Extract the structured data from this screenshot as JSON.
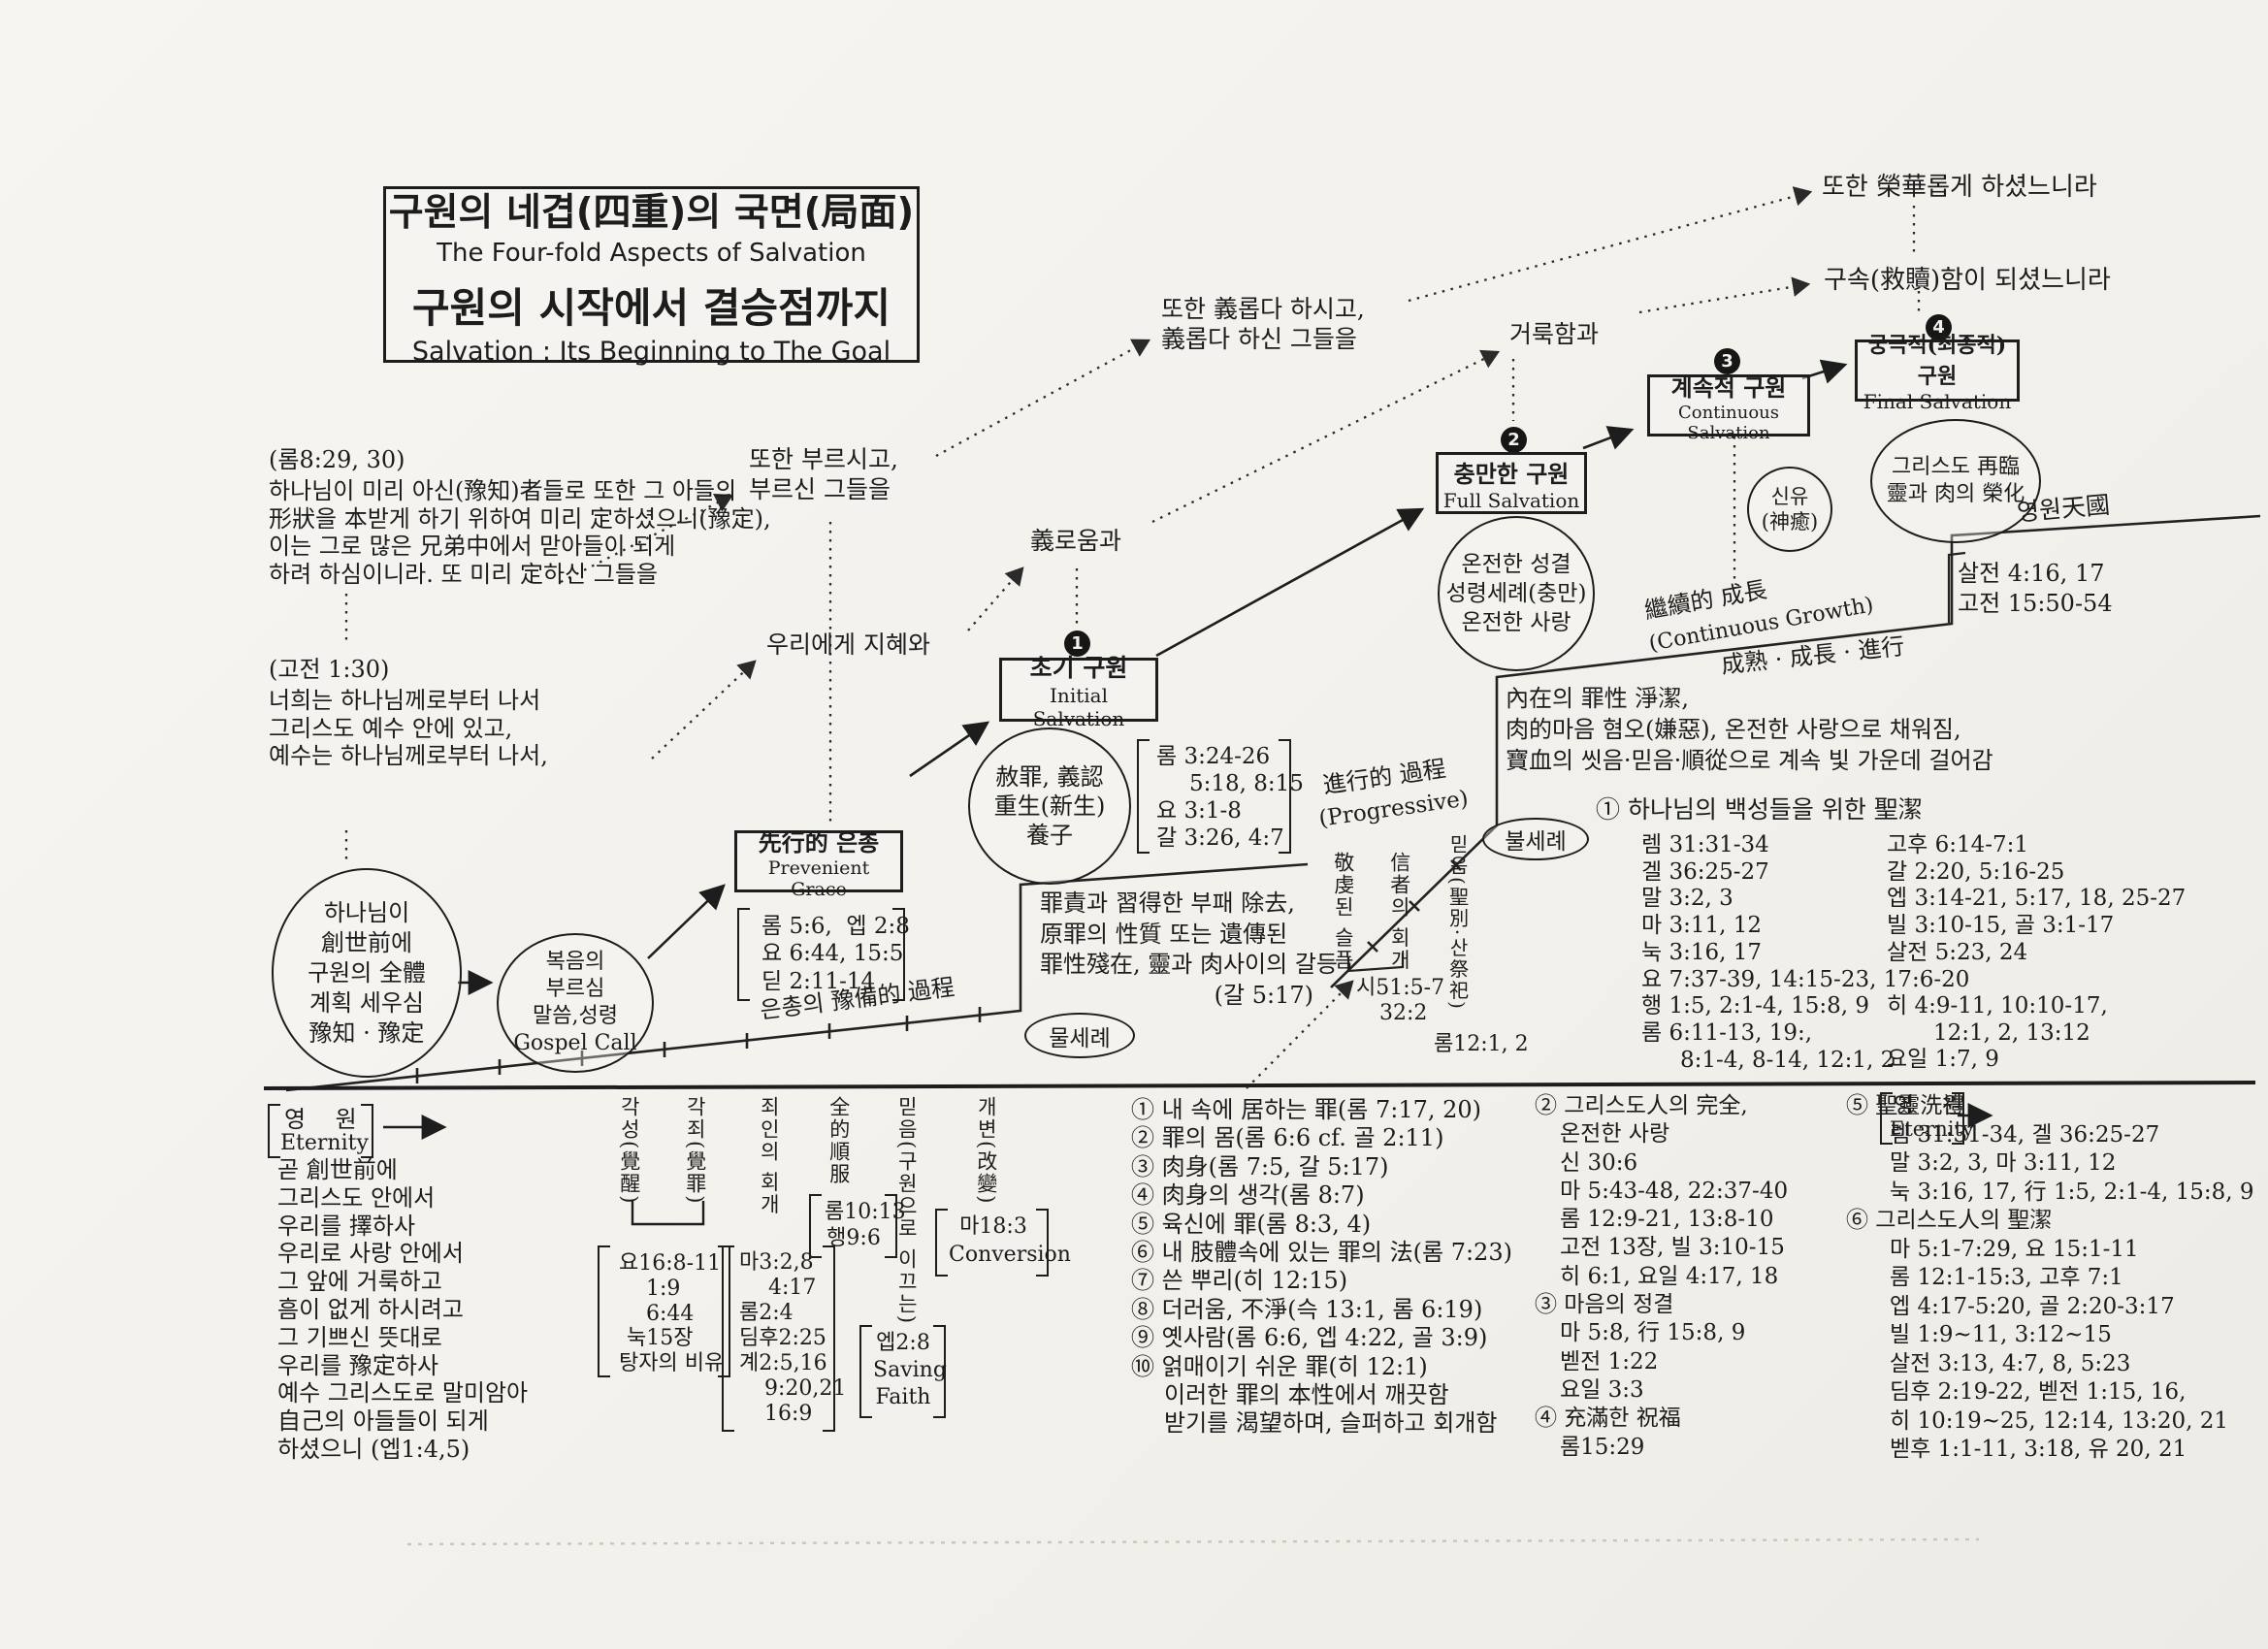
{
  "title": {
    "ko1": "구원의 네겹(四重)의 국면(局面)",
    "en1": "The Four-fold Aspects of Salvation",
    "ko2": "구원의 시작에서 결승점까지",
    "en2": "Salvation : Its Beginning to The Goal"
  },
  "quotes": {
    "rom8_ref": "(롬8:29, 30)",
    "rom8_lines": [
      "하나님이 미리 아신(豫知)者들로 또한 그 아들의",
      "形狀을 本받게 하기 위하여 미리 定하셨으니(豫定),",
      "이는 그로 많은 兄弟中에서 맏아들이 되게",
      "하려 하심이니라. 또 미리 定하신 그들을"
    ],
    "cor1_ref": "(고전 1:30)",
    "cor1_lines": [
      "너희는 하나님께로부터 나서",
      "그리스도 예수 안에 있고,",
      "예수는 하나님께로부터 나서,"
    ],
    "called_lines": [
      "또한 부르시고,",
      "부르신 그들을"
    ],
    "wisdom": "우리에게 지혜와",
    "righteousness": "義로움과",
    "justified_lines": [
      "또한 義롭다 하시고,",
      "義롭다 하신 그들을"
    ],
    "holiness": "거룩함과",
    "glorified": "또한 榮華롭게 하셨느니라",
    "redeemed": "구속(救贖)함이 되셨느니라"
  },
  "ovals": {
    "plan": [
      "하나님이",
      "創世前에",
      "구원의 全體",
      "계획 세우심",
      "豫知 · 豫定"
    ],
    "gospel_call": [
      "복음의",
      "부르심",
      "말씀,성령",
      "Gospel Call"
    ],
    "initial_grace": [
      "赦罪, 義認",
      "重生(新生)",
      "養子"
    ],
    "full_grace": [
      "온전한 성결",
      "성령세례(충만)",
      "온전한 사랑"
    ],
    "healing": [
      "신유",
      "(神癒)"
    ],
    "second_coming": [
      "그리스도 再臨",
      "靈과 肉의 榮化"
    ],
    "water_baptism": "물세례",
    "fire_baptism": "불세례"
  },
  "stages": [
    {
      "num": "1",
      "ko": "초기 구원",
      "en": "Initial Salvation"
    },
    {
      "num": "2",
      "ko": "충만한 구원",
      "en": "Full Salvation"
    },
    {
      "num": "3",
      "ko": "계속적 구원",
      "en": "Continuous Salvation"
    },
    {
      "num": "4",
      "ko": "궁극적(최종적) 구원",
      "en": "Final Salvation"
    }
  ],
  "prevenient": {
    "ko": "先行的 은총",
    "en": "Prevenient Grace",
    "verses": [
      "롬 5:6,  엡 2:8",
      "요 6:44, 15:5",
      "딛 2:11-14"
    ]
  },
  "initial_verses": [
    "롬 3:24-26",
    "5:18, 8:15",
    "요 3:1-8",
    "갈 3:26, 4:7"
  ],
  "process": {
    "preparatory": "은총의 豫備的 過程",
    "progressive_ko": "進行的 過程",
    "progressive_en": "(Progressive)",
    "growth_ko": "繼續的 成長",
    "growth_en": "(Continuous Growth)",
    "maturity": "成熟 · 成長 · 進行",
    "heaven": "영원天國"
  },
  "sin_box": [
    "罪責과 習得한 부패 除去,",
    "原罪의 性質 또는 遺傳된",
    "罪性殘在, 靈과 肉사이의 갈등",
    "(갈 5:17)"
  ],
  "inner_box": [
    "內在의 罪性 淨潔,",
    "肉的마음 혐오(嫌惡), 온전한 사랑으로 채워짐,",
    "寶血의 씻음·믿음·順從으로 계속 빛 가운데 걸어감"
  ],
  "vertical_mid": {
    "godly_sorrow": "敬虔된 슬픔",
    "believer_repentance": "信者의 회개",
    "sorrow_refs": [
      "시51:5-7",
      "32:2"
    ],
    "faith_consecration": "믿음(聖別·산祭祀)",
    "consecration_ref": "롬12:1, 2"
  },
  "final_refs": [
    "살전 4:16, 17",
    "고전 15:50-54"
  ],
  "sanctify_list": {
    "heading": "① 하나님의 백성들을 위한 聖潔",
    "left": [
      "렘 31:31-34",
      "겔 36:25-27",
      "말 3:2, 3",
      "마 3:11, 12",
      "눅 3:16, 17",
      "요 7:37-39, 14:15-23, 17:6-20",
      "행 1:5, 2:1-4, 15:8, 9",
      "롬 6:11-13, 19:,",
      "8:1-4, 8-14, 12:1, 2"
    ],
    "right_top": [
      "고후 6:14-7:1",
      "갈 2:20, 5:16-25",
      "엡 3:14-21, 5:17, 18, 25-27",
      "빌 3:10-15, 골 3:1-17",
      "살전 5:23, 24"
    ],
    "right_bottom": [
      "히 4:9-11, 10:10-17,",
      "12:1, 2, 13:12",
      "요일 1:7, 9"
    ]
  },
  "eternity": {
    "ko": "영    원",
    "en": "Eternity"
  },
  "bottom_left_lines": [
    "곧 創世前에",
    "그리스도 안에서",
    "우리를 擇하사",
    "우리로 사랑 안에서",
    "그 앞에 거룩하고",
    "흠이 없게 하시려고",
    "그 기쁘신 뜻대로",
    "우리를 豫定하사",
    "예수 그리스도로 말미암아",
    "自己의 아들들이 되게",
    "하셨으니 (엡1:4,5)"
  ],
  "vertical_cols": {
    "awakening": "각성(覺醒)",
    "conviction": "각죄(覺罪)",
    "awakening_refs": [
      "요16:8-11",
      "1:9",
      "6:44",
      "눅15장",
      "탕자의 비유"
    ],
    "repentance": "죄인의 회개",
    "repentance_refs": [
      "마3:2,8",
      "4:17",
      "롬2:4",
      "딤후2:25",
      "계2:5,16",
      "9:20,21",
      "16:9"
    ],
    "surrender": "全的順服",
    "surrender_refs": [
      "롬10:13",
      "행9:6"
    ],
    "faith": "믿음(구원으로 이끄는)",
    "faith_refs": [
      "엡2:8",
      "Saving",
      "Faith"
    ],
    "conversion": "개변(改變)",
    "conversion_refs": [
      "마18:3",
      "Conversion"
    ]
  },
  "sin_list": [
    "① 내 속에 居하는 罪(롬 7:17, 20)",
    "② 罪의 몸(롬 6:6 cf. 골 2:11)",
    "③ 肉身(롬 7:5, 갈 5:17)",
    "④ 肉身의 생각(롬 8:7)",
    "⑤ 육신에 罪(롬 8:3, 4)",
    "⑥ 내 肢體속에 있는 罪의 法(롬 7:23)",
    "⑦ 쓴 뿌리(히 12:15)",
    "⑧ 더러움, 不淨(슥 13:1, 롬 6:19)",
    "⑨ 옛사람(롬 6:6, 엡 4:22, 골 3:9)",
    "⑩ 얽매이기 쉬운 罪(히 12:1)",
    "이러한 罪의 本性에서 깨끗함",
    "받기를 渴望하며, 슬퍼하고 회개함"
  ],
  "col2": [
    "② 그리스도人의 完全,",
    "온전한 사랑",
    "신 30:6",
    "마 5:43-48, 22:37-40",
    "롬 12:9-21, 13:8-10",
    "고전 13장, 빌 3:10-15",
    "히 6:1, 요일 4:17, 18",
    "③ 마음의 정결",
    "마 5:8, 行 15:8, 9",
    "벧전 1:22",
    "요일 3:3",
    "④ 充滿한 祝福",
    "롬15:29"
  ],
  "col3": [
    "⑤ 聖靈洗禮",
    "렘 31:31-34, 겔 36:25-27",
    "말 3:2, 3, 마 3:11, 12",
    "눅 3:16, 17, 行 1:5, 2:1-4, 15:8, 9",
    "⑥ 그리스도人의 聖潔",
    "마 5:1-7:29, 요 15:1-11",
    "롬 12:1-15:3, 고후 7:1",
    "엡 4:17-5:20, 골 2:20-3:17",
    "빌 1:9~11, 3:12~15",
    "살전 3:13, 4:7, 8, 5:23",
    "딤후 2:19-22, 벧전 1:15, 16,",
    "히 10:19~25, 12:14, 13:20, 21",
    "벧후 1:1-11, 3:18, 유 20, 21"
  ]
}
